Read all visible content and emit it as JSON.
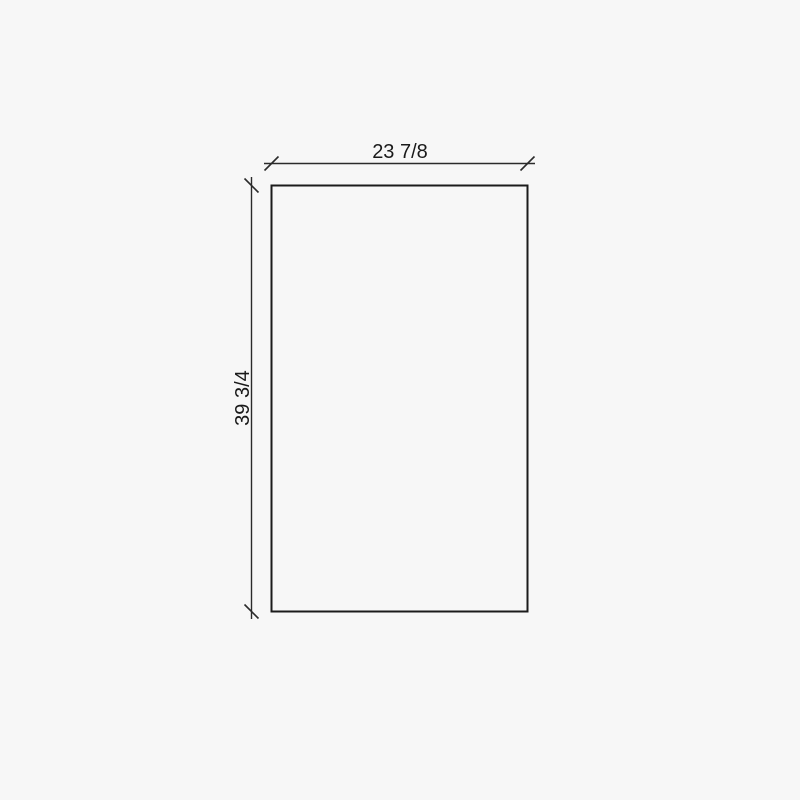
{
  "drawing": {
    "type": "panel-dimension-drawing",
    "width_label": "23 7/8",
    "height_label": "39 3/4"
  },
  "colors": {
    "background": "#f7f7f7",
    "outline": "#1b1b1b",
    "dimension_line": "#2b2b2b",
    "text": "#1a1a1a"
  }
}
